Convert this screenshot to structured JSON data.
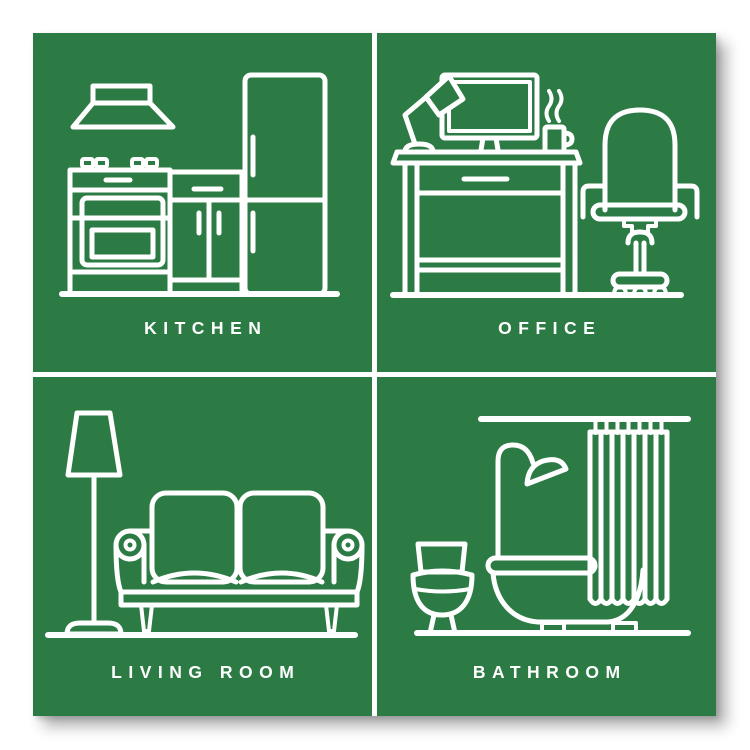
{
  "poster": {
    "background_color": "#ffffff",
    "panel_color": "#2c7b45",
    "line_color": "#ffffff",
    "panels": [
      {
        "id": "kitchen",
        "label": "KITCHEN",
        "icon": "kitchen-icon"
      },
      {
        "id": "office",
        "label": "OFFICE",
        "icon": "office-icon"
      },
      {
        "id": "living-room",
        "label": "LIVING ROOM",
        "icon": "living-room-icon"
      },
      {
        "id": "bathroom",
        "label": "BATHROOM",
        "icon": "bathroom-icon"
      }
    ]
  }
}
